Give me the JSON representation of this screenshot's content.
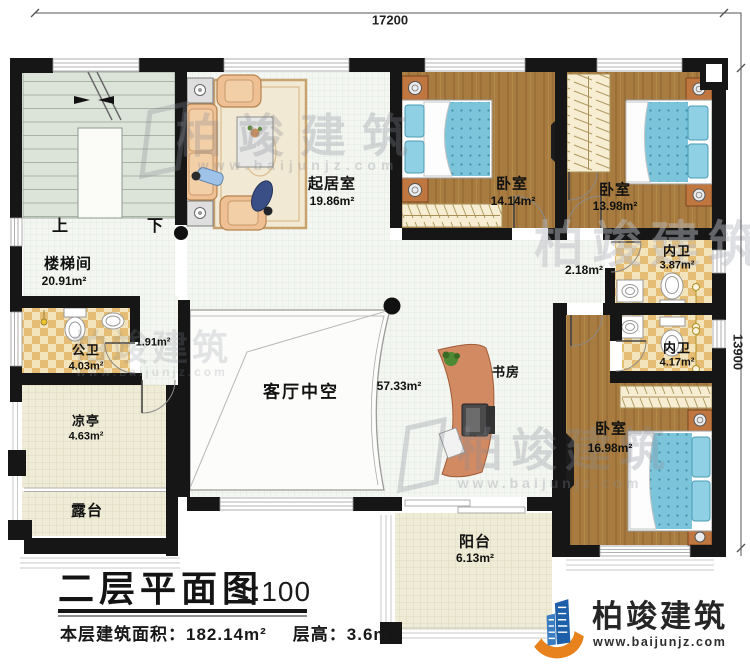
{
  "dimensions": {
    "top": "17200",
    "right": "13900"
  },
  "stairs": {
    "up": "上",
    "down": "下"
  },
  "rooms": {
    "stairwell": {
      "name": "楼梯间",
      "area": "20.91m²"
    },
    "living": {
      "name": "起居室",
      "area": "19.86m²"
    },
    "bedroom1": {
      "name": "卧室",
      "area": "14.14m²"
    },
    "bedroom2": {
      "name": "卧室",
      "area": "13.98m²"
    },
    "ensuite1": {
      "name": "内卫",
      "area": "3.87m²"
    },
    "ensuite2": {
      "name": "内卫",
      "area": "4.17m²"
    },
    "bedroom3": {
      "name": "卧室",
      "area": "16.98m²"
    },
    "study": {
      "name": "书房"
    },
    "hall": {
      "area": "57.33m²"
    },
    "nook": {
      "area": "2.18m²"
    },
    "vestibule": {
      "area": "1.91m²"
    },
    "void": {
      "name": "客厅中空"
    },
    "public_bath": {
      "name": "公卫",
      "area": "4.03m²"
    },
    "pavilion": {
      "name": "凉亭",
      "area": "4.63m²"
    },
    "terrace": {
      "name": "露台"
    },
    "balcony": {
      "name": "阳台",
      "area": "6.13m²"
    }
  },
  "title_block": {
    "title": "二层平面图",
    "scale": "1:100",
    "area_label": "本层建筑面积：",
    "area_value": "182.14m²",
    "height_label": "层高：",
    "height_value": "3.6m"
  },
  "logo": {
    "name": "柏竣建筑",
    "website": "www.baijunjz.com"
  },
  "watermark": {
    "text": "柏竣建筑",
    "website": "www.baijunjz.com"
  },
  "colors": {
    "wall": "#161616",
    "wood_floor": "#a87c40",
    "tile_tan": "#e5bd74",
    "bed_blue": "#7cc4da",
    "stair_green": "#dce3d8",
    "floor_cream": "#eeebd6",
    "logo_blue": "#1d5fa8",
    "logo_orange": "#e8821c"
  }
}
